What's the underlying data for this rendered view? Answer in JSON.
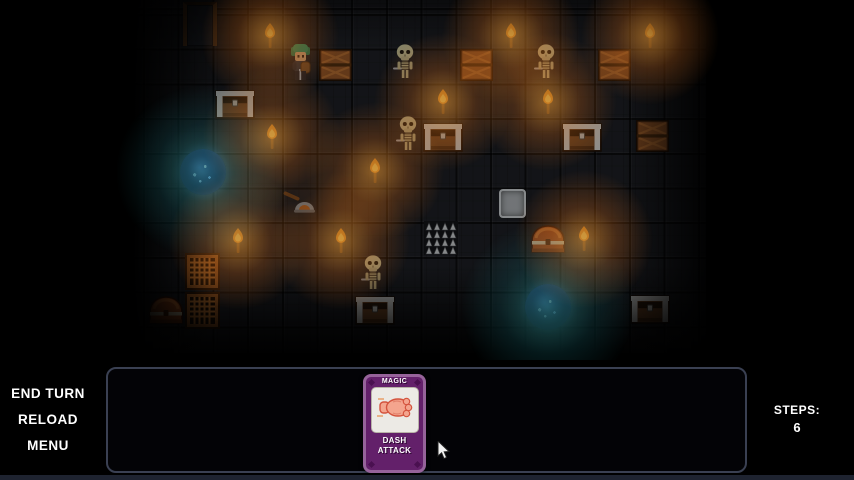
{
  "hud": {
    "buttons": [
      {
        "label": "END TURN"
      },
      {
        "label": "RELOAD"
      },
      {
        "label": "MENU"
      }
    ],
    "steps_label": "STEPS:",
    "steps_value": "6",
    "card": {
      "type_label": "MAGIC",
      "name_line1": "DASH",
      "name_line2": "ATTACK"
    }
  },
  "colors": {
    "card_purple": "#63206a",
    "card_frame": "#96639a",
    "torch_glow": "#ffa537",
    "portal_core": "#1c2c6e",
    "portal_glow": "#3cc2c8",
    "panel_border": "#3a4052",
    "hud_text": "#ffffff"
  },
  "map": {
    "tile_size": 35,
    "objects": [
      {
        "type": "door",
        "x": 200,
        "y": 24
      },
      {
        "type": "torch",
        "x": 270,
        "y": 36
      },
      {
        "type": "torch",
        "x": 511,
        "y": 36
      },
      {
        "type": "torch",
        "x": 650,
        "y": 36
      },
      {
        "type": "hero",
        "x": 300,
        "y": 63
      },
      {
        "type": "crate",
        "x": 335,
        "y": 65
      },
      {
        "type": "skeleton",
        "x": 405,
        "y": 62
      },
      {
        "type": "crate",
        "x": 476,
        "y": 65
      },
      {
        "type": "skeleton",
        "x": 546,
        "y": 62
      },
      {
        "type": "crate",
        "x": 614,
        "y": 65
      },
      {
        "type": "chest",
        "x": 235,
        "y": 104
      },
      {
        "type": "torch",
        "x": 443,
        "y": 102
      },
      {
        "type": "torch",
        "x": 548,
        "y": 102
      },
      {
        "type": "torch",
        "x": 272,
        "y": 137
      },
      {
        "type": "skeleton",
        "x": 408,
        "y": 134
      },
      {
        "type": "chest",
        "x": 443,
        "y": 137
      },
      {
        "type": "chest",
        "x": 582,
        "y": 137
      },
      {
        "type": "crate",
        "x": 652,
        "y": 136
      },
      {
        "type": "portal",
        "x": 203,
        "y": 172
      },
      {
        "type": "torch",
        "x": 375,
        "y": 171
      },
      {
        "type": "shovel",
        "x": 300,
        "y": 204
      },
      {
        "type": "plate",
        "x": 512,
        "y": 203
      },
      {
        "type": "spikes",
        "x": 441,
        "y": 238
      },
      {
        "type": "domechest",
        "x": 548,
        "y": 239
      },
      {
        "type": "torch",
        "x": 584,
        "y": 239
      },
      {
        "type": "torch",
        "x": 238,
        "y": 241
      },
      {
        "type": "torch",
        "x": 341,
        "y": 241
      },
      {
        "type": "gratecrate",
        "x": 202,
        "y": 271
      },
      {
        "type": "skeleton",
        "x": 373,
        "y": 273
      },
      {
        "type": "gratecrate",
        "x": 202,
        "y": 310
      },
      {
        "type": "domechest",
        "x": 166,
        "y": 310
      },
      {
        "type": "chest",
        "x": 375,
        "y": 310
      },
      {
        "type": "portal",
        "x": 548,
        "y": 307
      },
      {
        "type": "chest",
        "x": 650,
        "y": 309
      }
    ]
  }
}
